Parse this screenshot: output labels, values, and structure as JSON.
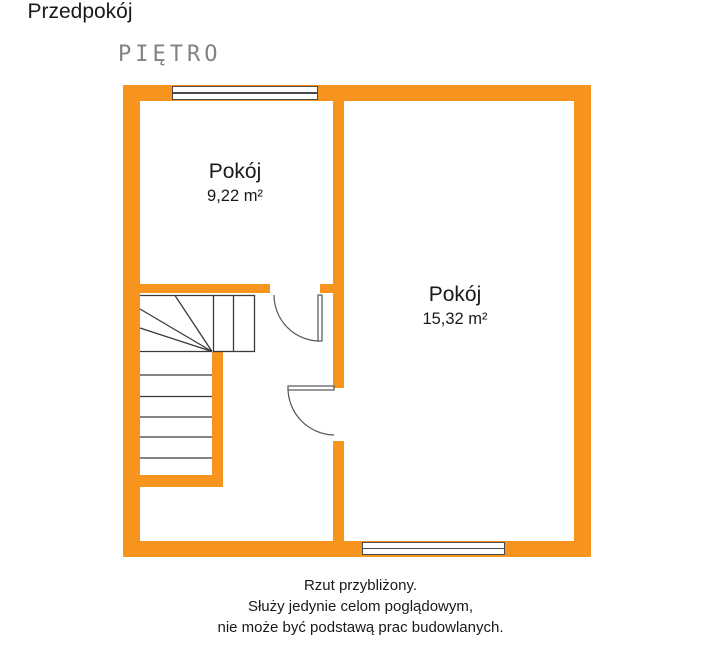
{
  "title": "PIĘTRO",
  "floorplan": {
    "rooms": [
      {
        "name": "Pokój",
        "area": "9,22 m²"
      },
      {
        "name": "Pokój",
        "area": "15,32 m²"
      },
      {
        "name": "Przedpokój"
      }
    ]
  },
  "disclaimer": {
    "lines": [
      "Rzut przybliżony.",
      "Służy jedynie celom poglądowym,",
      "nie może być podstawą prac budowlanych."
    ]
  },
  "colors": {
    "wall": "#F7941D",
    "frame": "#4a4a4a",
    "stair": "#3a3a3a",
    "door": "#555555",
    "title": "#828282",
    "text": "#1a1a1a"
  }
}
